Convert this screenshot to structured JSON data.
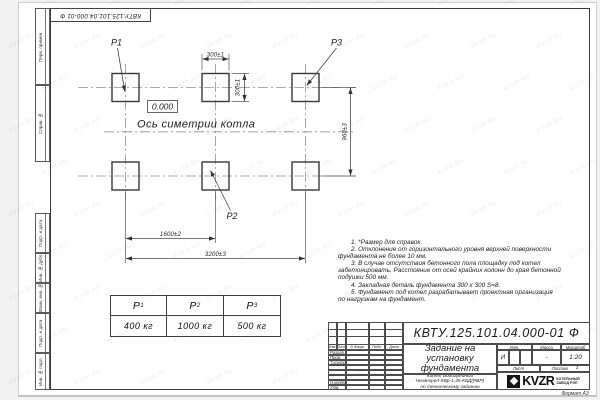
{
  "sheet": {
    "doc_number": "КВТУ.125.101.04.000-01 Ф",
    "format_label": "Формат А3",
    "watermark": "KVZR.RU"
  },
  "margin_labels": [
    "Перв. примен.",
    "Справ. №",
    "Подп. и дата",
    "Инв. № дубл.",
    "Взам. инв. №",
    "Подп. и дата",
    "Инв. № подл."
  ],
  "drawing": {
    "labels": {
      "p1": "P1",
      "p2": "P2",
      "p3": "P3"
    },
    "elevation": "0.000",
    "axis_label": "Ось симетрии котла",
    "dims": {
      "top": "300±1",
      "side": "300±1",
      "height": "960±3",
      "half": "1600±2",
      "full": "3200±3"
    }
  },
  "load_table": {
    "headers": [
      {
        "base": "P",
        "sub": "1"
      },
      {
        "base": "P",
        "sub": "2"
      },
      {
        "base": "P",
        "sub": "3"
      }
    ],
    "values": [
      "400 кг",
      "1000 кг",
      "500 кг"
    ]
  },
  "notes": [
    "1. *Размер для справок.",
    "2. Отклонение от горизонтального уровня верхней поверхности",
    "фундамента не более 10 мм.",
    "3. В случае отсутствия бетонного пола площадку под котел",
    "забетонировать. Расстояние от осей крайних колонн до края бетонной",
    "подушки 500 мм.",
    "4. Закладная деталь фундамента  300 х 300  S=8.",
    "5. Фундамент под котел разрабатывает проектная организация",
    "по нагрузкам на фундамент."
  ],
  "title_block": {
    "header_cols": [
      "Изм.",
      "Лист",
      "N докум.",
      "Подп.",
      "Дата"
    ],
    "sign_rows": [
      "Разраб.",
      "Пров.",
      "Т.контр.",
      "Н.контр.",
      "Утв."
    ],
    "title_lines": [
      "Задание на",
      "установку",
      "фундамента"
    ],
    "subtitle_lines": [
      "Котел Водогрейный",
      "Heatexpert-КВр-1,45-КБД(РВР)",
      "по техническому заданию"
    ],
    "lit_label": "Лит.",
    "mass_label": "Масса",
    "scale_label": "Масштаб",
    "lit_value": "И",
    "mass_value": "-",
    "scale_value": "1:20",
    "sheet_label": "Лист",
    "sheets_label": "Листов",
    "sheets_value": "1",
    "logo_text": "KVZR",
    "logo_caption": [
      "КОТЕЛЬНЫЙ",
      "ЗАВОД РЭП"
    ]
  }
}
